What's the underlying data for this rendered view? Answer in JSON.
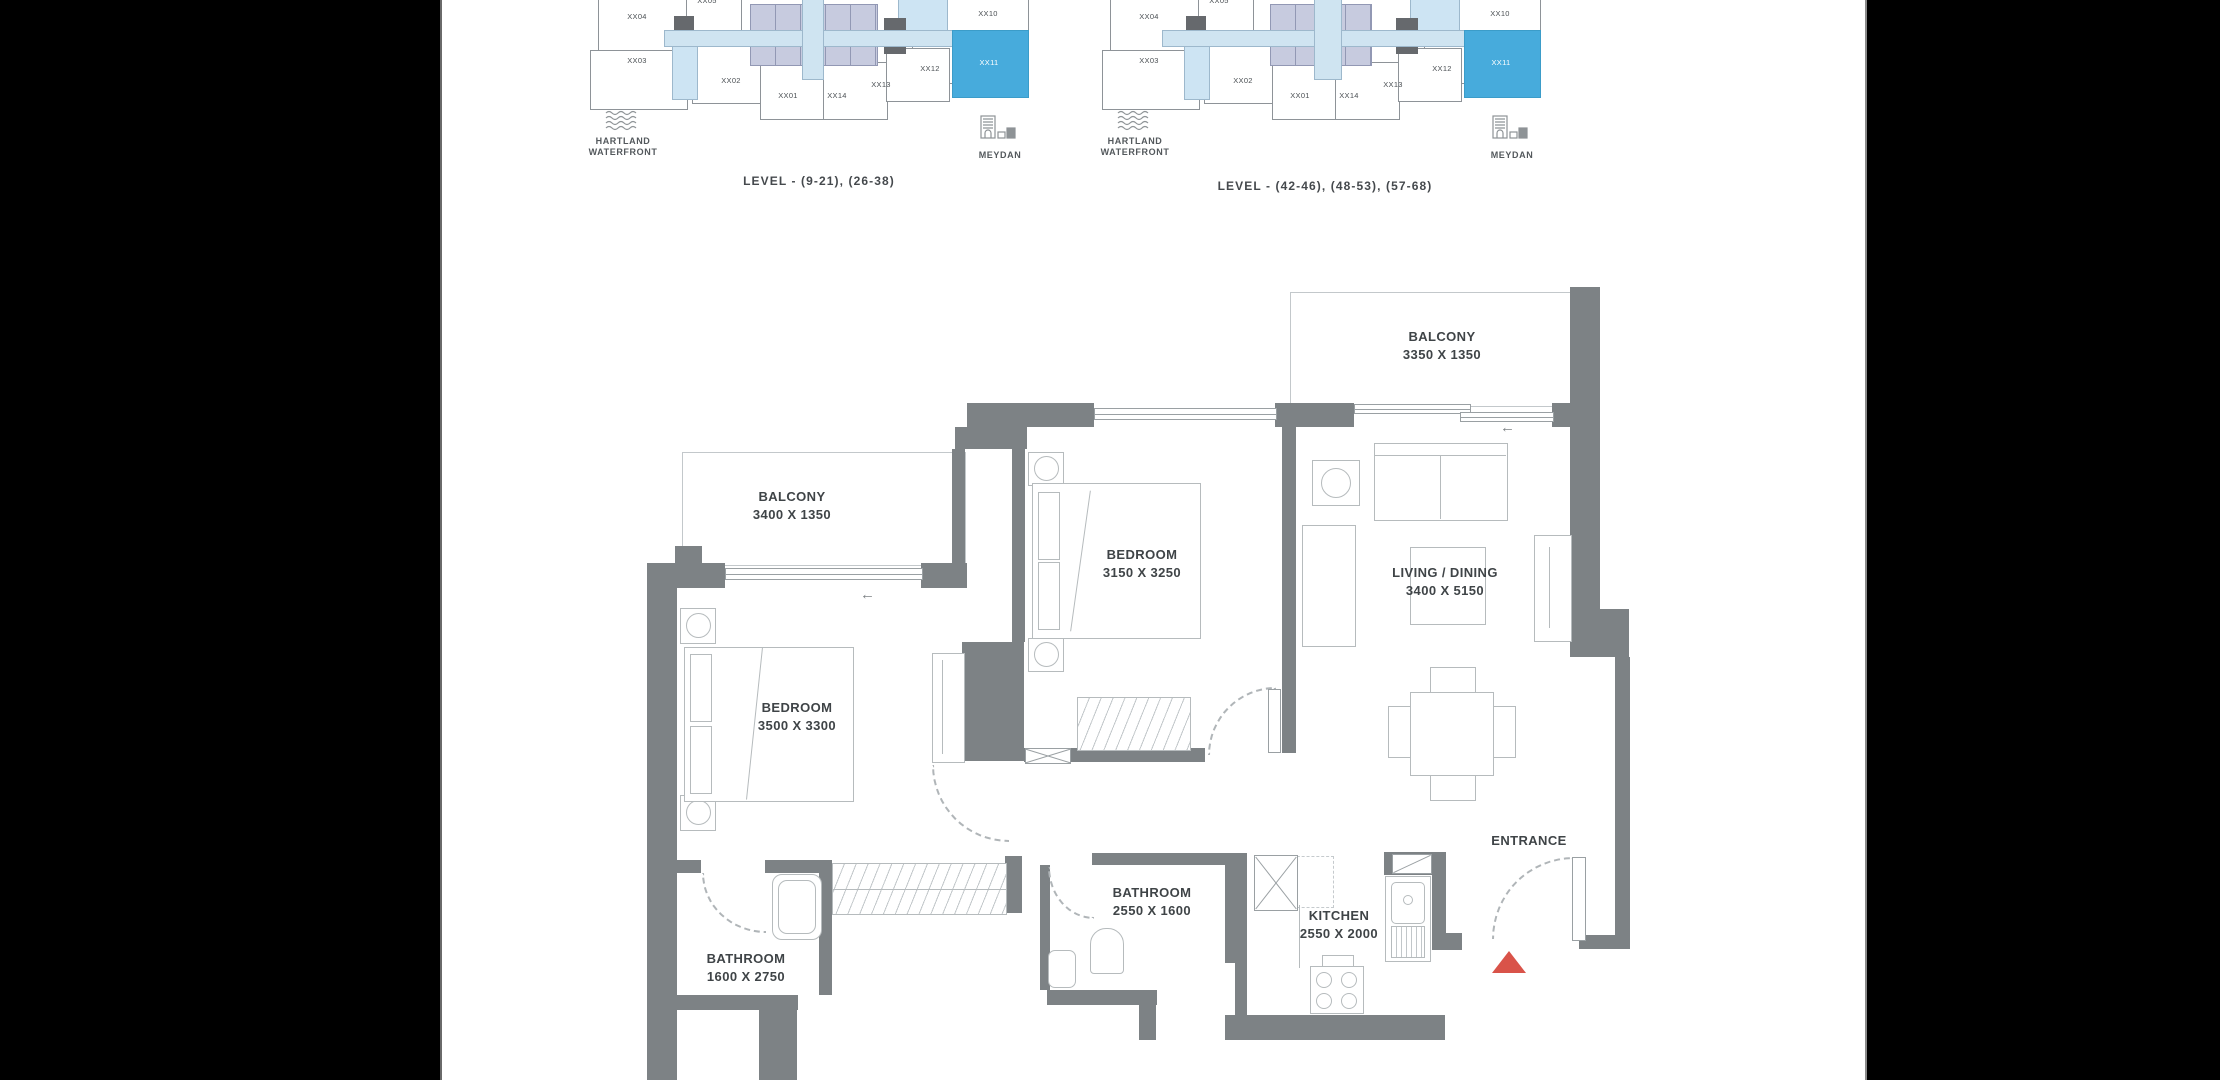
{
  "key_plans": [
    {
      "caption": "LEVEL - (9-21), (26-38)",
      "units": [
        "XX04",
        "XX05",
        "XX03",
        "XX02",
        "XX01",
        "XX14",
        "XX13",
        "XX12",
        "XX11",
        "XX10"
      ],
      "highlighted_unit": "XX11",
      "landmark_left_line1": "HARTLAND",
      "landmark_left_line2": "WATERFRONT",
      "landmark_right": "MEYDAN"
    },
    {
      "caption": "LEVEL - (42-46), (48-53), (57-68)",
      "units": [
        "XX04",
        "XX05",
        "XX03",
        "XX02",
        "XX01",
        "XX14",
        "XX13",
        "XX12",
        "XX11",
        "XX10"
      ],
      "highlighted_unit": "XX11",
      "landmark_left_line1": "HARTLAND",
      "landmark_left_line2": "WATERFRONT",
      "landmark_right": "MEYDAN"
    }
  ],
  "floor_plan": {
    "balcony_top": {
      "name": "BALCONY",
      "dims": "3350 X 1350"
    },
    "balcony_left": {
      "name": "BALCONY",
      "dims": "3400 X 1350"
    },
    "bedroom_mid": {
      "name": "BEDROOM",
      "dims": "3150 X 3250"
    },
    "living": {
      "name": "LIVING / DINING",
      "dims": "3400 X 5150"
    },
    "bedroom_left": {
      "name": "BEDROOM",
      "dims": "3500 X 3300"
    },
    "bathroom_mid": {
      "name": "BATHROOM",
      "dims": "2550 X 1600"
    },
    "kitchen": {
      "name": "KITCHEN",
      "dims": "2550 X 2000"
    },
    "bathroom_left": {
      "name": "BATHROOM",
      "dims": "1600 X 2750"
    },
    "entrance": {
      "name": "ENTRANCE"
    }
  },
  "colors": {
    "highlight_unit": "#47abdc",
    "wall": "#7d8285",
    "entrance_marker": "#d95349",
    "corridor": "#cfe4f1",
    "core_units": "#c7cbdf",
    "light_unit": "#cde4f3"
  }
}
